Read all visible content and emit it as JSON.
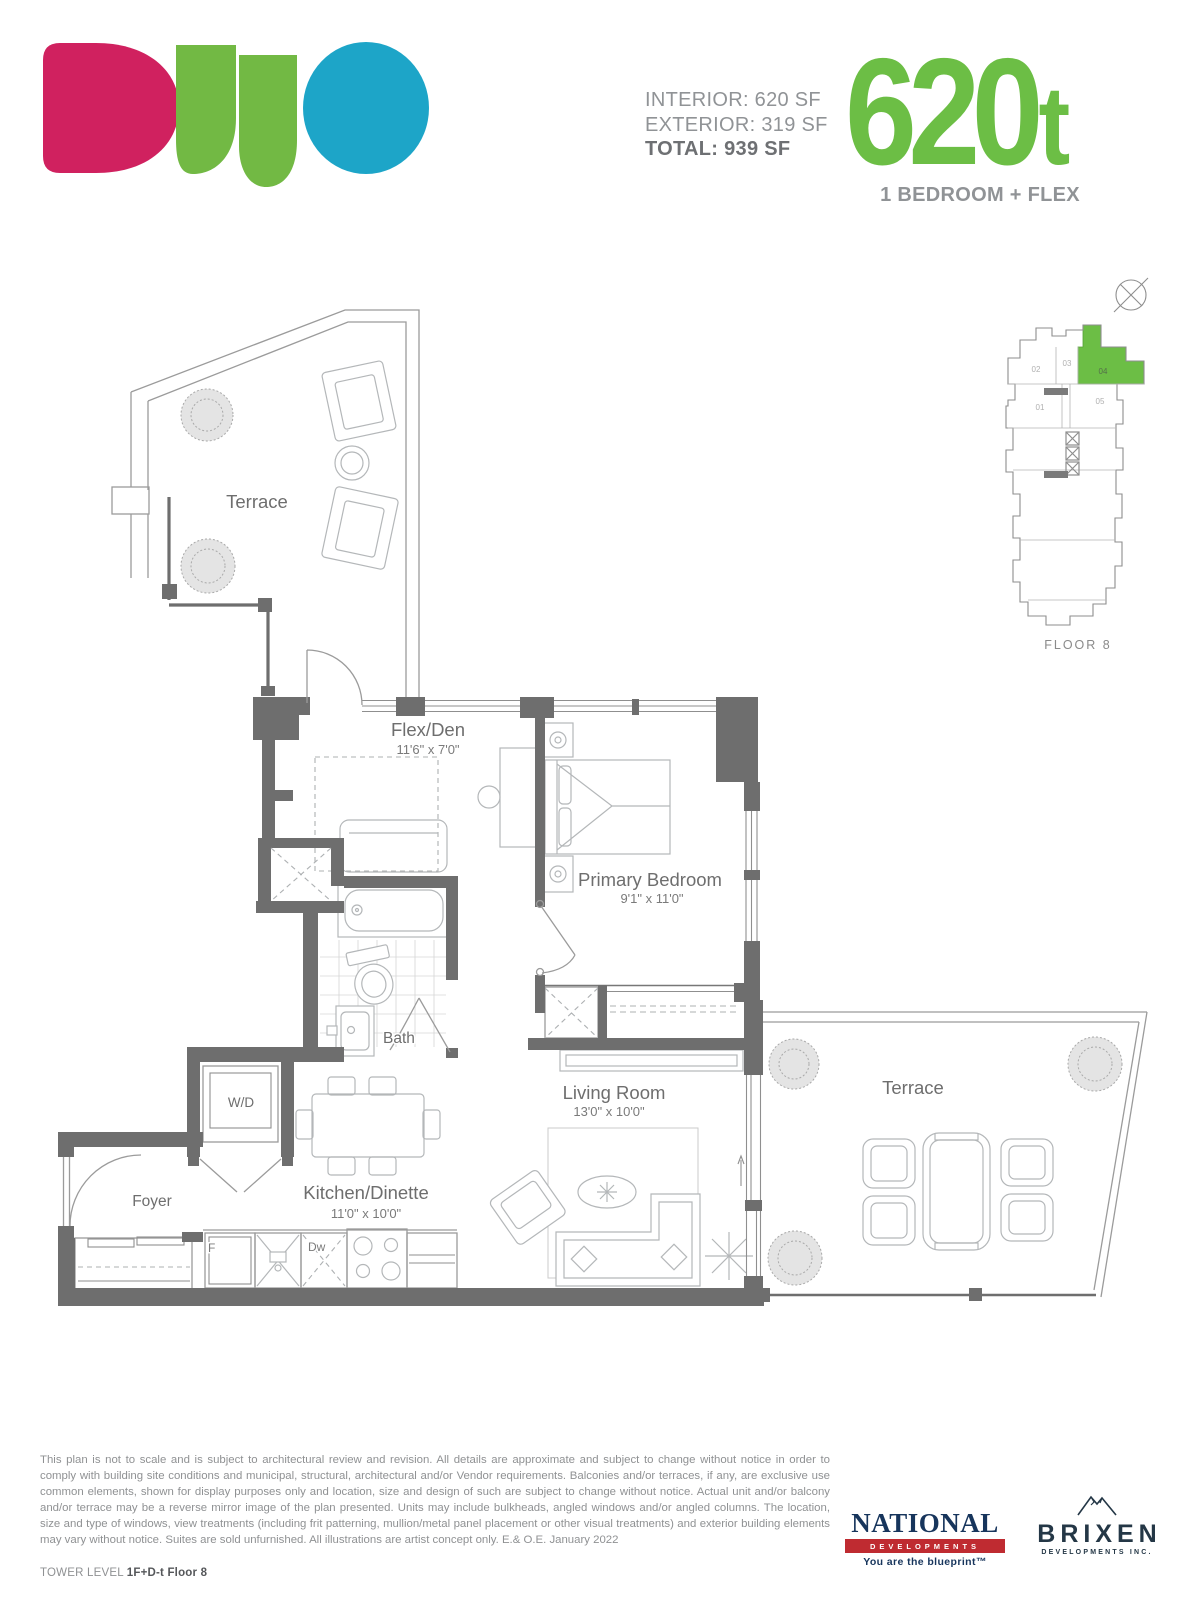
{
  "header": {
    "areas": {
      "interior": "INTERIOR: 620 SF",
      "exterior": "EXTERIOR: 319 SF",
      "total": "TOTAL: 939 SF"
    },
    "unit_number": "620",
    "unit_suffix": "t",
    "unit_type": "1 BEDROOM + FLEX"
  },
  "brand_colors": {
    "logo_pink": "#d0215f",
    "logo_green": "#72b944",
    "logo_blue": "#1da5c8",
    "accent_green": "#6cbe45",
    "wall_gray": "#6e6e6e",
    "national_red": "#bf2b31",
    "national_navy": "#17355c"
  },
  "keyplan": {
    "floor_label": "FLOOR 8",
    "highlighted_unit": "04",
    "units": {
      "u01": "01",
      "u02": "02",
      "u03": "03",
      "u04": "04",
      "u05": "05"
    }
  },
  "floorplan": {
    "terrace_top": {
      "name": "Terrace"
    },
    "flex": {
      "name": "Flex/Den",
      "dims": "11'6\" x 7'0\""
    },
    "bedroom": {
      "name": "Primary Bedroom",
      "dims": "9'1\" x 11'0\""
    },
    "bath": {
      "name": "Bath"
    },
    "wd": {
      "name": "W/D"
    },
    "foyer": {
      "name": "Foyer"
    },
    "kitchen": {
      "name": "Kitchen/Dinette",
      "dims": "11'0\" x 10'0\""
    },
    "living": {
      "name": "Living Room",
      "dims": "13'0\" x 10'0\""
    },
    "terrace_right": {
      "name": "Terrace"
    },
    "fridge": "F",
    "dishwasher": "Dw"
  },
  "footer": {
    "disclaimer": "This plan is not to scale and is subject to architectural review and revision. All details are approximate and subject to change without notice in order to comply with building site conditions and municipal, structural, architectural and/or Vendor requirements. Balconies and/or terraces, if any, are exclusive use common elements, shown for display purposes only and location, size and design of such are subject to change without notice. Actual unit and/or balcony and/or terrace may be a reverse mirror image of the plan presented. Units may include bulkheads, angled windows and/or angled columns. The location, size and type of windows, view treatments (including frit patterning, mullion/metal panel placement or other visual treatments) and exterior building elements may vary without notice. Suites are sold unfurnished. All illustrations are artist concept only. E.& O.E. January 2022",
    "tower_level_label": "TOWER LEVEL ",
    "tower_level_value": "1F+D-t Floor 8",
    "national": {
      "name": "NATIONAL",
      "division": "DEVELOPMENTS",
      "tagline": "You are the blueprint™"
    },
    "brixen": {
      "name": "BRIXEN",
      "division": "DEVELOPMENTS INC."
    }
  }
}
